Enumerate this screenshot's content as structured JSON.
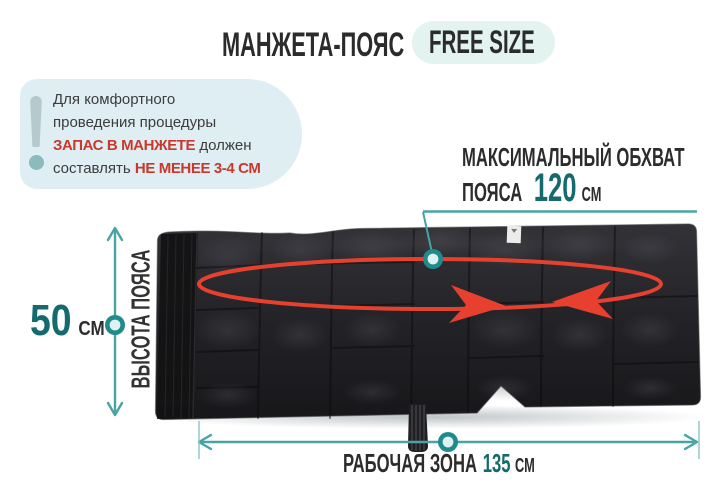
{
  "header": {
    "title": "МАНЖЕТА-ПОЯС",
    "badge": "FREE SIZE"
  },
  "note": {
    "icon": "exclamation",
    "line1": "Для комфортного",
    "line2": "проведения процедуры",
    "line3_highlight": "ЗАПАС В МАНЖЕТЕ",
    "line3_rest": " должен",
    "line4_start": "составлять ",
    "line4_highlight": "НЕ МЕНЕЕ 3-4 СМ"
  },
  "measurements": {
    "max_girth": {
      "label_line1": "МАКСИМАЛЬНЫЙ ОБХВАТ",
      "label_line2": "ПОЯСА",
      "value": "120",
      "unit": "СМ"
    },
    "belt_height": {
      "label": "ВЫСОТА ПОЯСА",
      "value": "50",
      "unit": "СМ"
    },
    "working_zone": {
      "label": "РАБОЧАЯ ЗОНА",
      "value": "135",
      "unit": "СМ"
    }
  },
  "colors": {
    "accent_teal": "#156a6e",
    "line_teal": "#48a3a4",
    "alert_red": "#c9382b",
    "arrow_red": "#e8402e",
    "note_bg": "#deeef3",
    "badge_bg": "#e3f3f0",
    "belt_dark": "#212125",
    "text_dark": "#2e2e2e"
  }
}
